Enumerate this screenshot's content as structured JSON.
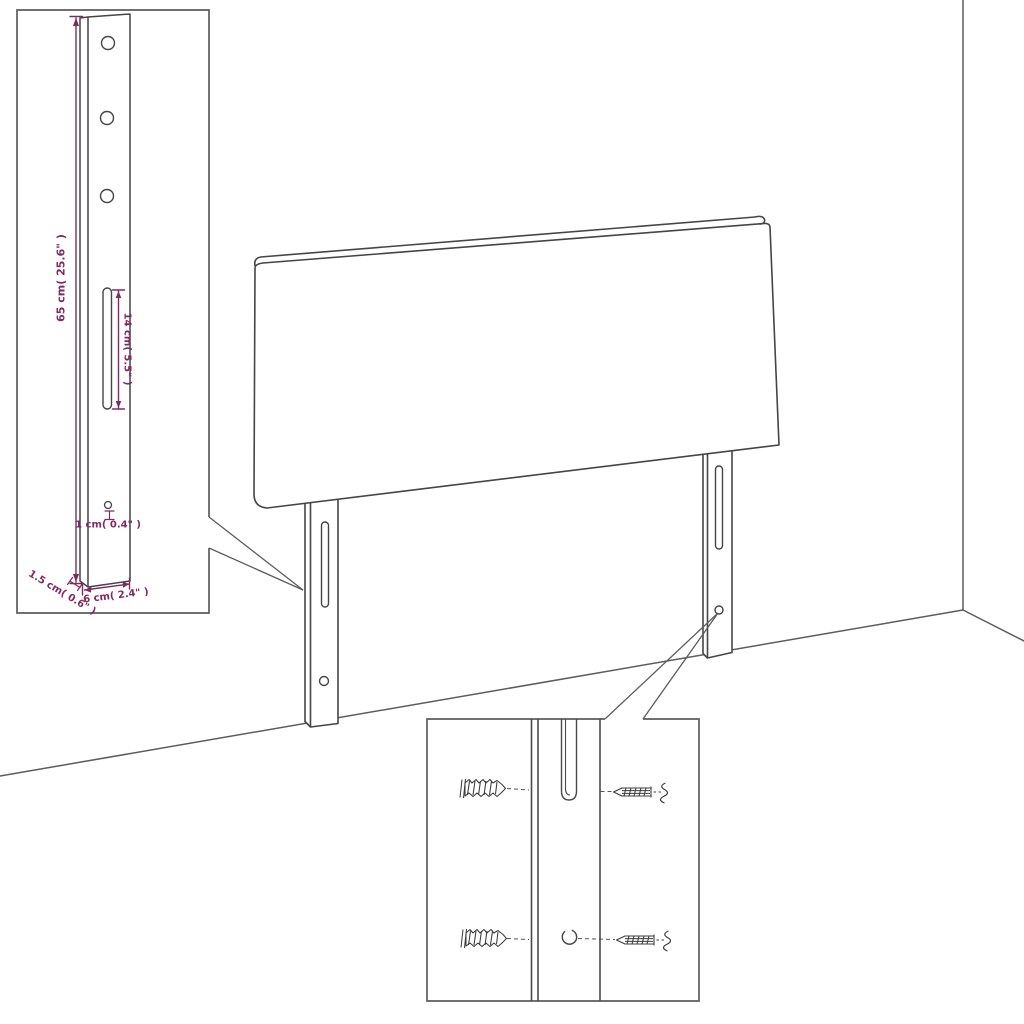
{
  "canvas": {
    "width": 1024,
    "height": 1024,
    "background": "#ffffff"
  },
  "colors": {
    "line": "#454545",
    "box_border": "#5c5c5c",
    "dimension": "#7f2a63",
    "fill": "#ffffff"
  },
  "bracket_inset": {
    "name": "leg bracket dimension detail",
    "dimensions": {
      "height": "65 cm( 25.6\" )",
      "slot_length": "14 cm( 5.5\" )",
      "hole_diameter": "1 cm( 0.4\" )",
      "width": "6 cm( 2.4\" )",
      "thickness": "1.5 cm( 0.6\" )"
    },
    "round_hole_count": 3,
    "small_hole_count": 1,
    "slot_count": 1
  },
  "hardware_inset": {
    "name": "wall mounting hardware detail",
    "wall_plug_count": 2,
    "screw_count": 2
  },
  "headboard": {
    "leg_count": 2,
    "slots_per_leg": 1,
    "holes_per_leg": 1
  }
}
